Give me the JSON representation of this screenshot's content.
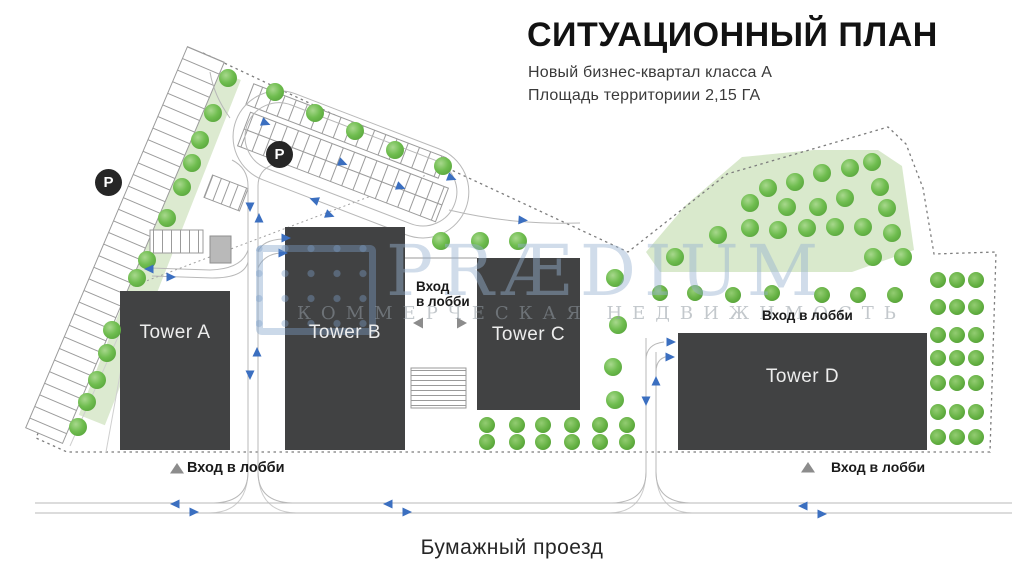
{
  "header": {
    "title": "СИТУАЦИОННЫЙ ПЛАН",
    "subtitle_line1": "Новый бизнес-квартал класса А",
    "subtitle_line2": "Площадь территориии 2,15 ГА"
  },
  "towers": {
    "a": "Tower A",
    "b": "Tower B",
    "c": "Tower C",
    "d": "Tower D"
  },
  "labels": {
    "parking_letter": "P",
    "lobby_entrance": "Вход в лобби",
    "lobby_entrance_line1": "Вход",
    "lobby_entrance_line2": "в лобби",
    "street_name": "Бумажный проезд"
  },
  "watermark": {
    "brand": "PRÆDIUM",
    "tagline": "КОММЕРЧЕСКАЯ НЕДВИЖИМОСТЬ"
  },
  "colors": {
    "tower": "#414243",
    "green_area": "#d9e9cc",
    "tree": "#6fbd4f",
    "route_arrow": "#3b6fc0",
    "boundary": "#7c7c7c",
    "watermark": "#96b2d0"
  }
}
